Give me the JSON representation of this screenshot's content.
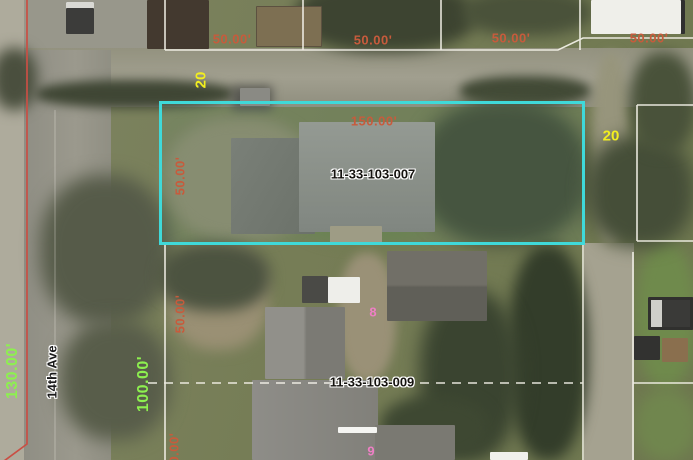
{
  "labels": {
    "lot_widths_top": [
      "50.00'",
      "50.00'",
      "50.00'",
      "50.00'"
    ],
    "selected_parcel": {
      "apn": "11-33-103-007",
      "frontage": "150.00'",
      "depth": "50.00'"
    },
    "south_parcel": {
      "apn": "11-33-103-009",
      "depth": "50.00'",
      "depth_partial": "50.00'"
    },
    "lot_numbers": {
      "west": "20",
      "east": "20"
    },
    "house_numbers": {
      "north": "8",
      "south": "9"
    },
    "street_frontages": {
      "south": "130.00'",
      "north": "100.00'"
    },
    "street_name": "14th Ave"
  },
  "colors": {
    "parcel_highlight": "#3fd9d9",
    "parcel_line": "#f5f3ea",
    "dimension_text": "#c75b3c",
    "lot_number_text": "#f2ee1f",
    "frontage_text": "#8df04f",
    "house_number_text": "#ee7fc5",
    "road_centerline": "#c94f44"
  }
}
